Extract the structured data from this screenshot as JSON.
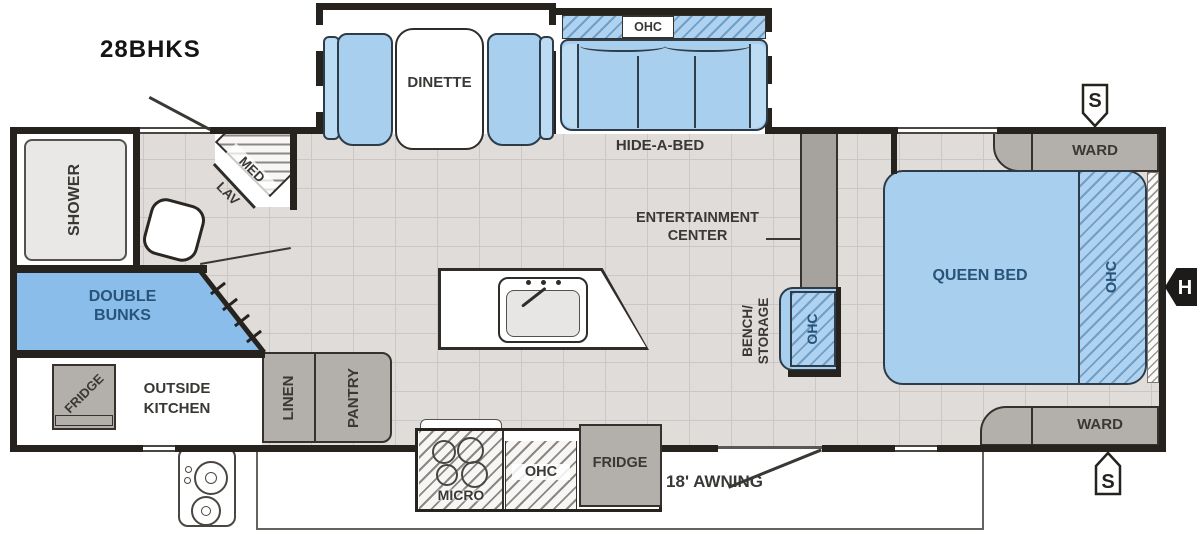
{
  "title": "28BHKS",
  "plan": {
    "bathroom": {
      "shower": "SHOWER",
      "med": "MED",
      "lav": "LAV"
    },
    "bunks": {
      "line1": "DOUBLE",
      "line2": "BUNKS"
    },
    "outside_kitchen": {
      "fridge": "FRIDGE",
      "line1": "OUTSIDE",
      "line2": "KITCHEN"
    },
    "storage": {
      "linen": "LINEN",
      "pantry": "PANTRY"
    },
    "dinette": {
      "label": "DINETTE"
    },
    "sofa": {
      "label": "HIDE-A-BED",
      "ohc": "OHC"
    },
    "kitchen": {
      "micro": "MICRO",
      "ohc": "OHC",
      "fridge": "FRIDGE"
    },
    "living": {
      "entertainment_line1": "ENTERTAINMENT",
      "entertainment_line2": "CENTER",
      "bench_line1": "BENCH/",
      "bench_line2": "STORAGE",
      "bench_ohc": "OHC"
    },
    "bedroom": {
      "bed": "QUEEN BED",
      "ohc": "OHC",
      "ward_top": "WARD",
      "ward_bottom": "WARD"
    },
    "awning": "18' AWNING",
    "markers": {
      "speaker_top": "S",
      "speaker_bottom": "S",
      "hitch": "H"
    }
  },
  "colors": {
    "wall": "#26231f",
    "floor": "#dfdcd9",
    "furniture_blue": "#a9cfee",
    "bunk_blue": "#8abdea",
    "cabinet_gray": "#b3b0ac",
    "label_dark": "#3a3835",
    "label_blue": "#28547a"
  }
}
